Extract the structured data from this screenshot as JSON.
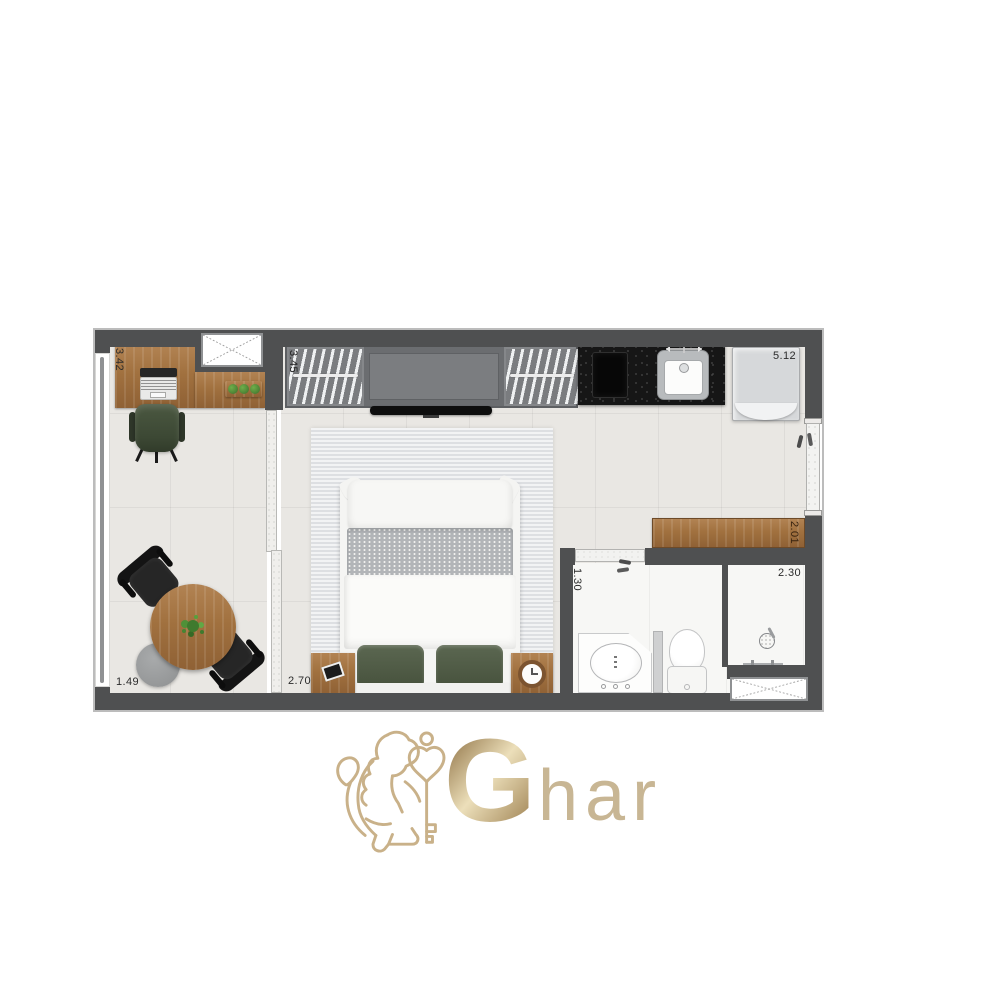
{
  "brand": {
    "name": "Ghar",
    "initial": "G",
    "rest": "har",
    "gold_color": "#c8b189"
  },
  "plan": {
    "wall_color": "#4f5051",
    "wood_color": "#a5774a",
    "dimensions": {
      "office_depth": "3.42",
      "office_width": "1.49",
      "wardrobe_length": "3.45",
      "bedroom_width": "2.70",
      "living_length": "5.12",
      "counter_length": "2.01",
      "bathroom_width": "1.30",
      "shower_width": "2.30"
    }
  }
}
